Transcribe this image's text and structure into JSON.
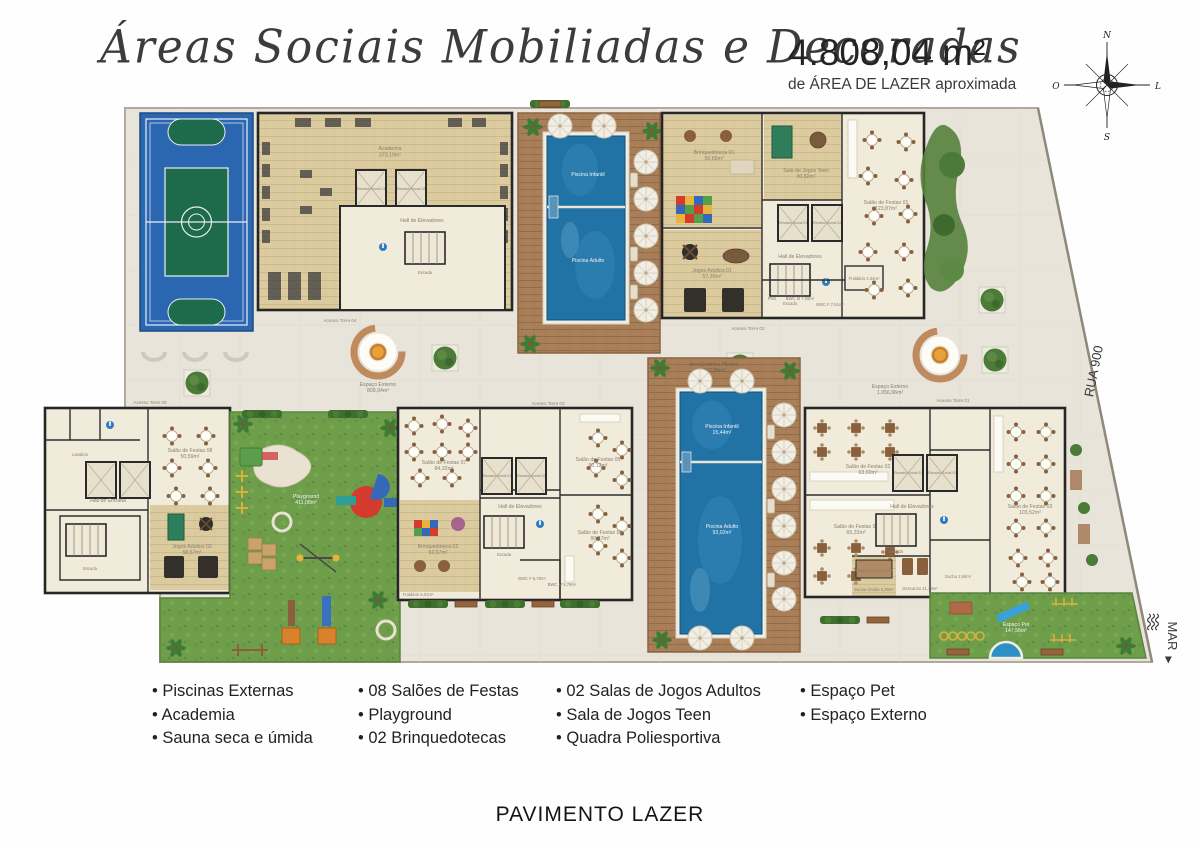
{
  "header": {
    "title": "Áreas Sociais Mobiliadas e Decoradas",
    "area_value": "4.808,04 m²",
    "area_caption": "de ÁREA DE LAZER aproximada",
    "compass": {
      "n": "N",
      "e": "L",
      "s": "S",
      "w": "O"
    }
  },
  "plan": {
    "street": "RUA 900",
    "sea": "MAR",
    "sea_arrow": "▶",
    "labels": {
      "academia": "Academia",
      "academia_area": "373,19m²",
      "hall_elevadores": "Hall de Elevadores",
      "hall_entrada": "Hall de Entrada",
      "escada": "Escada",
      "elevador1": "Elevador Social 01",
      "elevador2": "Elevador Social 02",
      "piscina_infantil": "Piscina Infantil",
      "piscina_adulto": "Piscina Adulto",
      "piscina_infantil2_area": "15,44m²",
      "piscina_adulto2_area": "93,02m²",
      "area_externa_piscina": "Área Externa Piscina",
      "area_externa_piscina_area": "412,28m²",
      "brinquedoteca1": "Brinquedoteca 01",
      "brinquedoteca1_area": "50,66m²",
      "brinquedoteca2": "Brinquedoteca 02",
      "brinquedoteca2_area": "52,67m²",
      "sala_jogos_teen": "Sala de Jogos Teen",
      "sala_jogos_teen_area": "30,82m²",
      "jogos_adultos1": "Jogos Adultos 01",
      "jogos_adultos1_area": "57,30m²",
      "jogos_adultos2": "Jogos Adultos 02",
      "jogos_adultos2_area": "58,57m²",
      "salao1": "Salão de Festas 01",
      "salao1_area": "123,87m²",
      "salao2": "Salão de Festas 02",
      "salao2_area": "63,60m²",
      "salao3": "Salão de Festas 03",
      "salao3_area": "103,52m²",
      "salao4": "Salão de Festas 04",
      "salao4_area": "65,32m²",
      "salao5": "Salão de Festas 05",
      "salao5_area": "90,12m²",
      "salao6": "Salão de Festas 06",
      "salao6_area": "90,47m²",
      "salao7": "Salão de Festas 07",
      "salao7_area": "84,32m²",
      "salao8": "Salão de Festas 08",
      "salao8_area": "50,59m²",
      "fraldario1": "Fraldário 4,34m²",
      "fraldario2": "Fraldário 5,01m²",
      "bwc_m1": "BWC M 7,08m²",
      "bwc_f1": "BWC F 7,51m²",
      "bwc_f2": "BWC F 5,78m²",
      "bwc_m2": "BWC M 5,76m²",
      "pne": "PNE",
      "lavabos": "Lavabos",
      "sauna_seca": "Sauna Seca 7,28m²",
      "sauna_umida": "Sauna Úmida 6,39m²",
      "descanso": "Descanso 21,79m²",
      "ducha": "Ducha 2,94m²",
      "playground": "Playground",
      "playground_area": "411,08m²",
      "espaco_pet": "Espaço Pet",
      "espaco_pet_area": "147,56m²",
      "espaco_externo": "Espaço Externo",
      "espaco_externo1_area": "809,94m²",
      "espaco_externo2_area": "1.056,96m²",
      "acesso1": "Acesso Torre 01",
      "acesso2": "Acesso Torre 02",
      "acesso3": "Acesso Torre 03",
      "acesso4": "Acesso Torre 04",
      "acesso5": "Acesso Torre 05"
    }
  },
  "legend": {
    "columns": [
      [
        "Piscinas Externas",
        "Academia",
        "Sauna seca e úmida"
      ],
      [
        "08 Salões de Festas",
        "Playground",
        "02 Brinquedotecas"
      ],
      [
        "02 Salas de Jogos Adultos",
        "Sala de Jogos Teen",
        "Quadra Poliesportiva"
      ],
      [
        "Espaço Pet",
        "Espaço Externo"
      ]
    ]
  },
  "footer": {
    "title": "PAVIMENTO LAZER"
  },
  "colors": {
    "paving": "#e8e4da",
    "building": "#f1ebdc",
    "wood_floor": "#dccb9f",
    "deck": "#a87f58",
    "pool": "#2173a5",
    "court_blue": "#2b66b1",
    "court_green": "#1d6b4a",
    "grass": "#6f9e4b",
    "wall": "#262626"
  }
}
